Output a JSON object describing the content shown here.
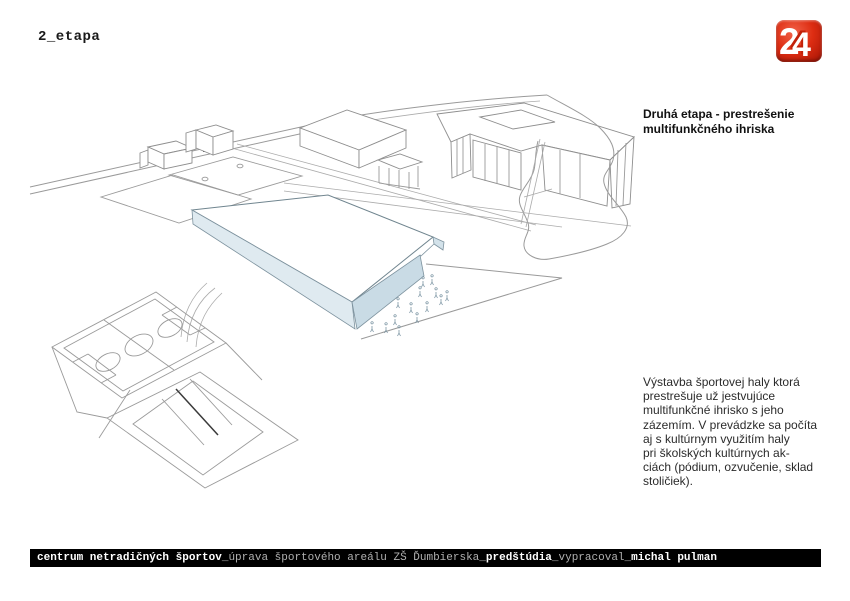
{
  "page": {
    "title_label": "2_etapa"
  },
  "logo": {
    "digit_back": "2",
    "digit_front": "4",
    "bg_color": "#dd2d12"
  },
  "annotation": {
    "heading": "Druhá etapa - prestrešenie\nmultifunkčného ihriska",
    "body": "Výstavba športovej haly ktorá\nprestrešuje už jestvujúce\nmultifunkčné ihrisko s jeho\nzázemím. V prevádzke sa počíta\naj s kultúrnym využitím haly\npri školských kultúrnych ak-\nciách (pódium, ozvučenie, sklad\nstoličiek)."
  },
  "footer": {
    "segments": [
      {
        "text": "centrum netradičných športov",
        "bold": true
      },
      {
        "text": "_úprava športového areálu ZŠ Ďumbierska_",
        "bold": false
      },
      {
        "text": "predštúdia",
        "bold": true
      },
      {
        "text": "_vypracoval_",
        "bold": false
      },
      {
        "text": "michal pulman",
        "bold": true
      }
    ]
  },
  "drawing": {
    "hall_roof_color": "#ffffff",
    "hall_left_face_color": "#dfeaf0",
    "hall_front_face_color": "#c9dbe5",
    "line_color": "#9a9a9a"
  }
}
